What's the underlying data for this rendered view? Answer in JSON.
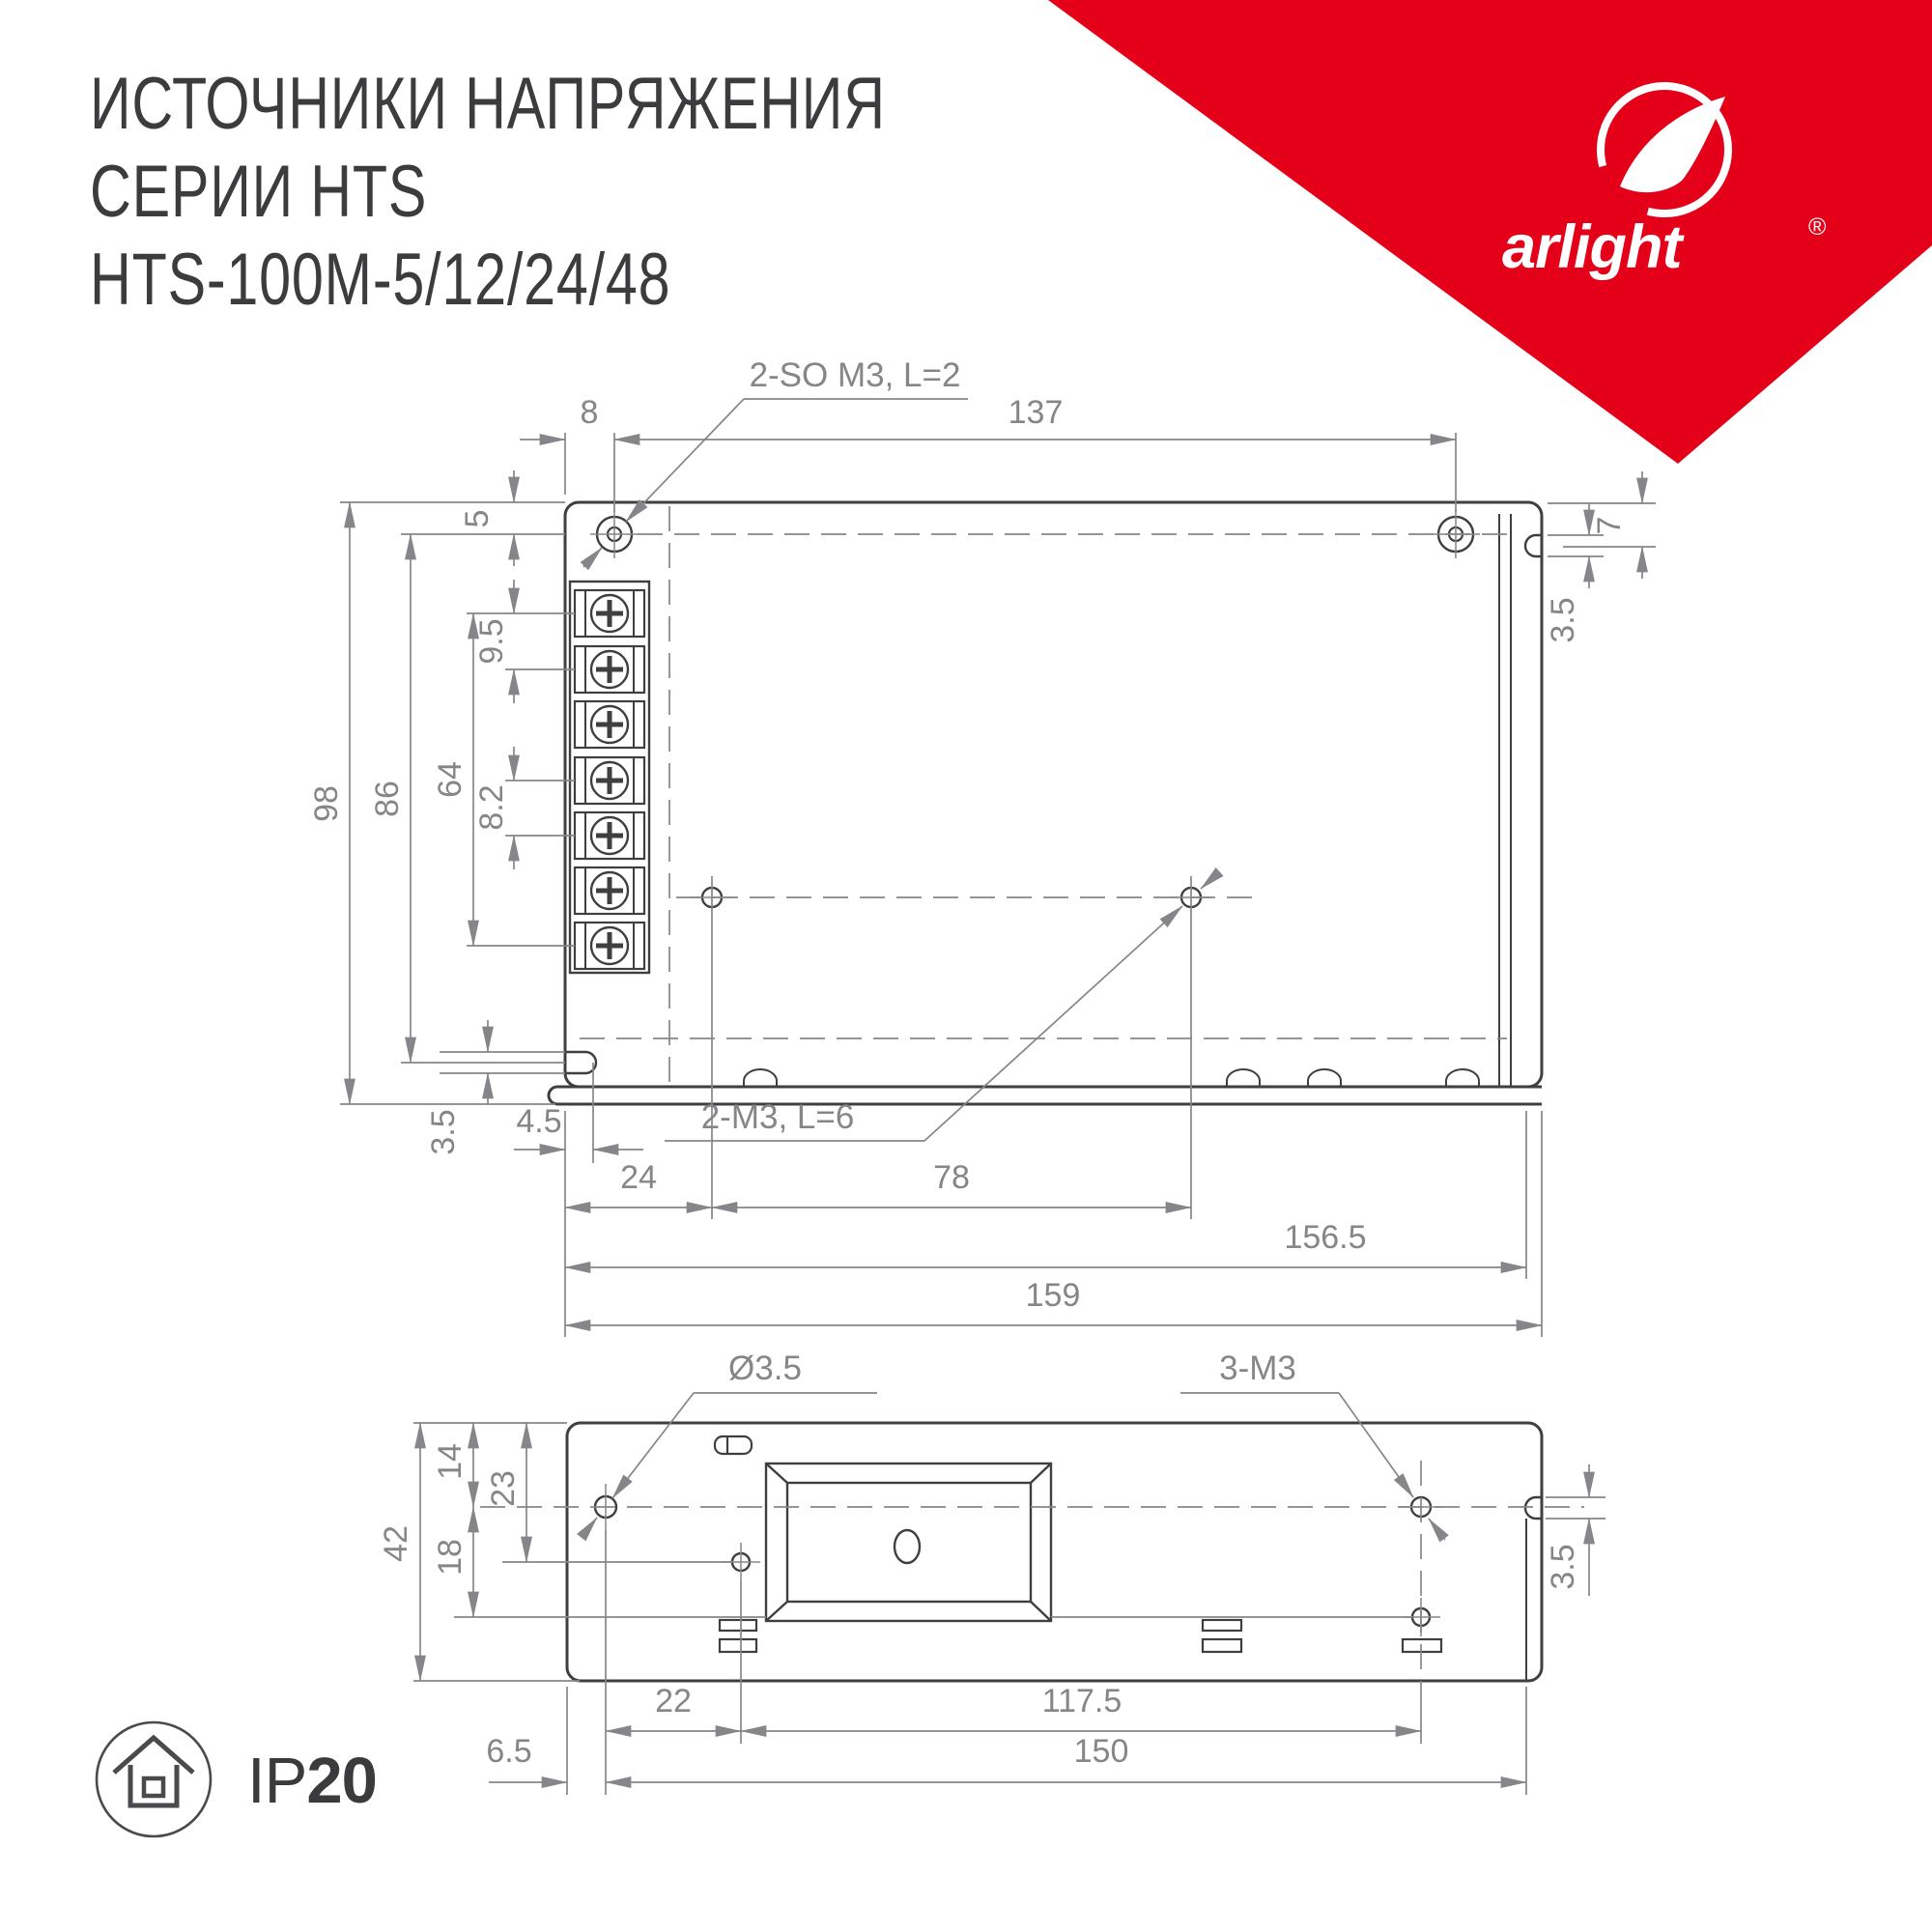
{
  "header": {
    "title_line1": "ИСТОЧНИКИ НАПРЯЖЕНИЯ",
    "title_line2": "СЕРИИ HTS",
    "title_line3": "HTS-100M-5/12/24/48"
  },
  "brand": {
    "name": "arlight",
    "registered": "®"
  },
  "colors": {
    "accent_red": "#e50019",
    "drawing_line": "#3f3f41",
    "dimension_line": "#86868a",
    "title_text": "#3c3c3e"
  },
  "top_view": {
    "leader_note_top": "2-SO M3, L=2",
    "leader_note_bottom": "2-M3, L=6",
    "dims": {
      "hole_offset_x": "8",
      "hole_span_x": "137",
      "hole_offset_y": "5",
      "terminal_pitch_upper": "9.5",
      "terminal_span": "64",
      "terminal_pitch_lower": "8.2",
      "notch_offset_y": "86",
      "height_total": "98",
      "right_notch_center": "7",
      "right_notch_width": "3.5",
      "left_notch_width": "3.5",
      "left_notch_depth": "4.5",
      "base_hole_x": "24",
      "base_hole_span": "78",
      "width_to_step": "156.5",
      "width_total": "159"
    }
  },
  "bottom_view": {
    "leader_note_left": "Ø3.5",
    "leader_note_right": "3-M3",
    "dims": {
      "centerline_offset": "14",
      "hole2_offset": "23",
      "height_total": "42",
      "hole3_offset": "18",
      "notch_width": "3.5",
      "hole_gap": "22",
      "hole_span": "117.5",
      "edge_to_hole": "6.5",
      "span_total": "150"
    }
  },
  "footer": {
    "ip_prefix": "IP",
    "ip_value": "20"
  }
}
